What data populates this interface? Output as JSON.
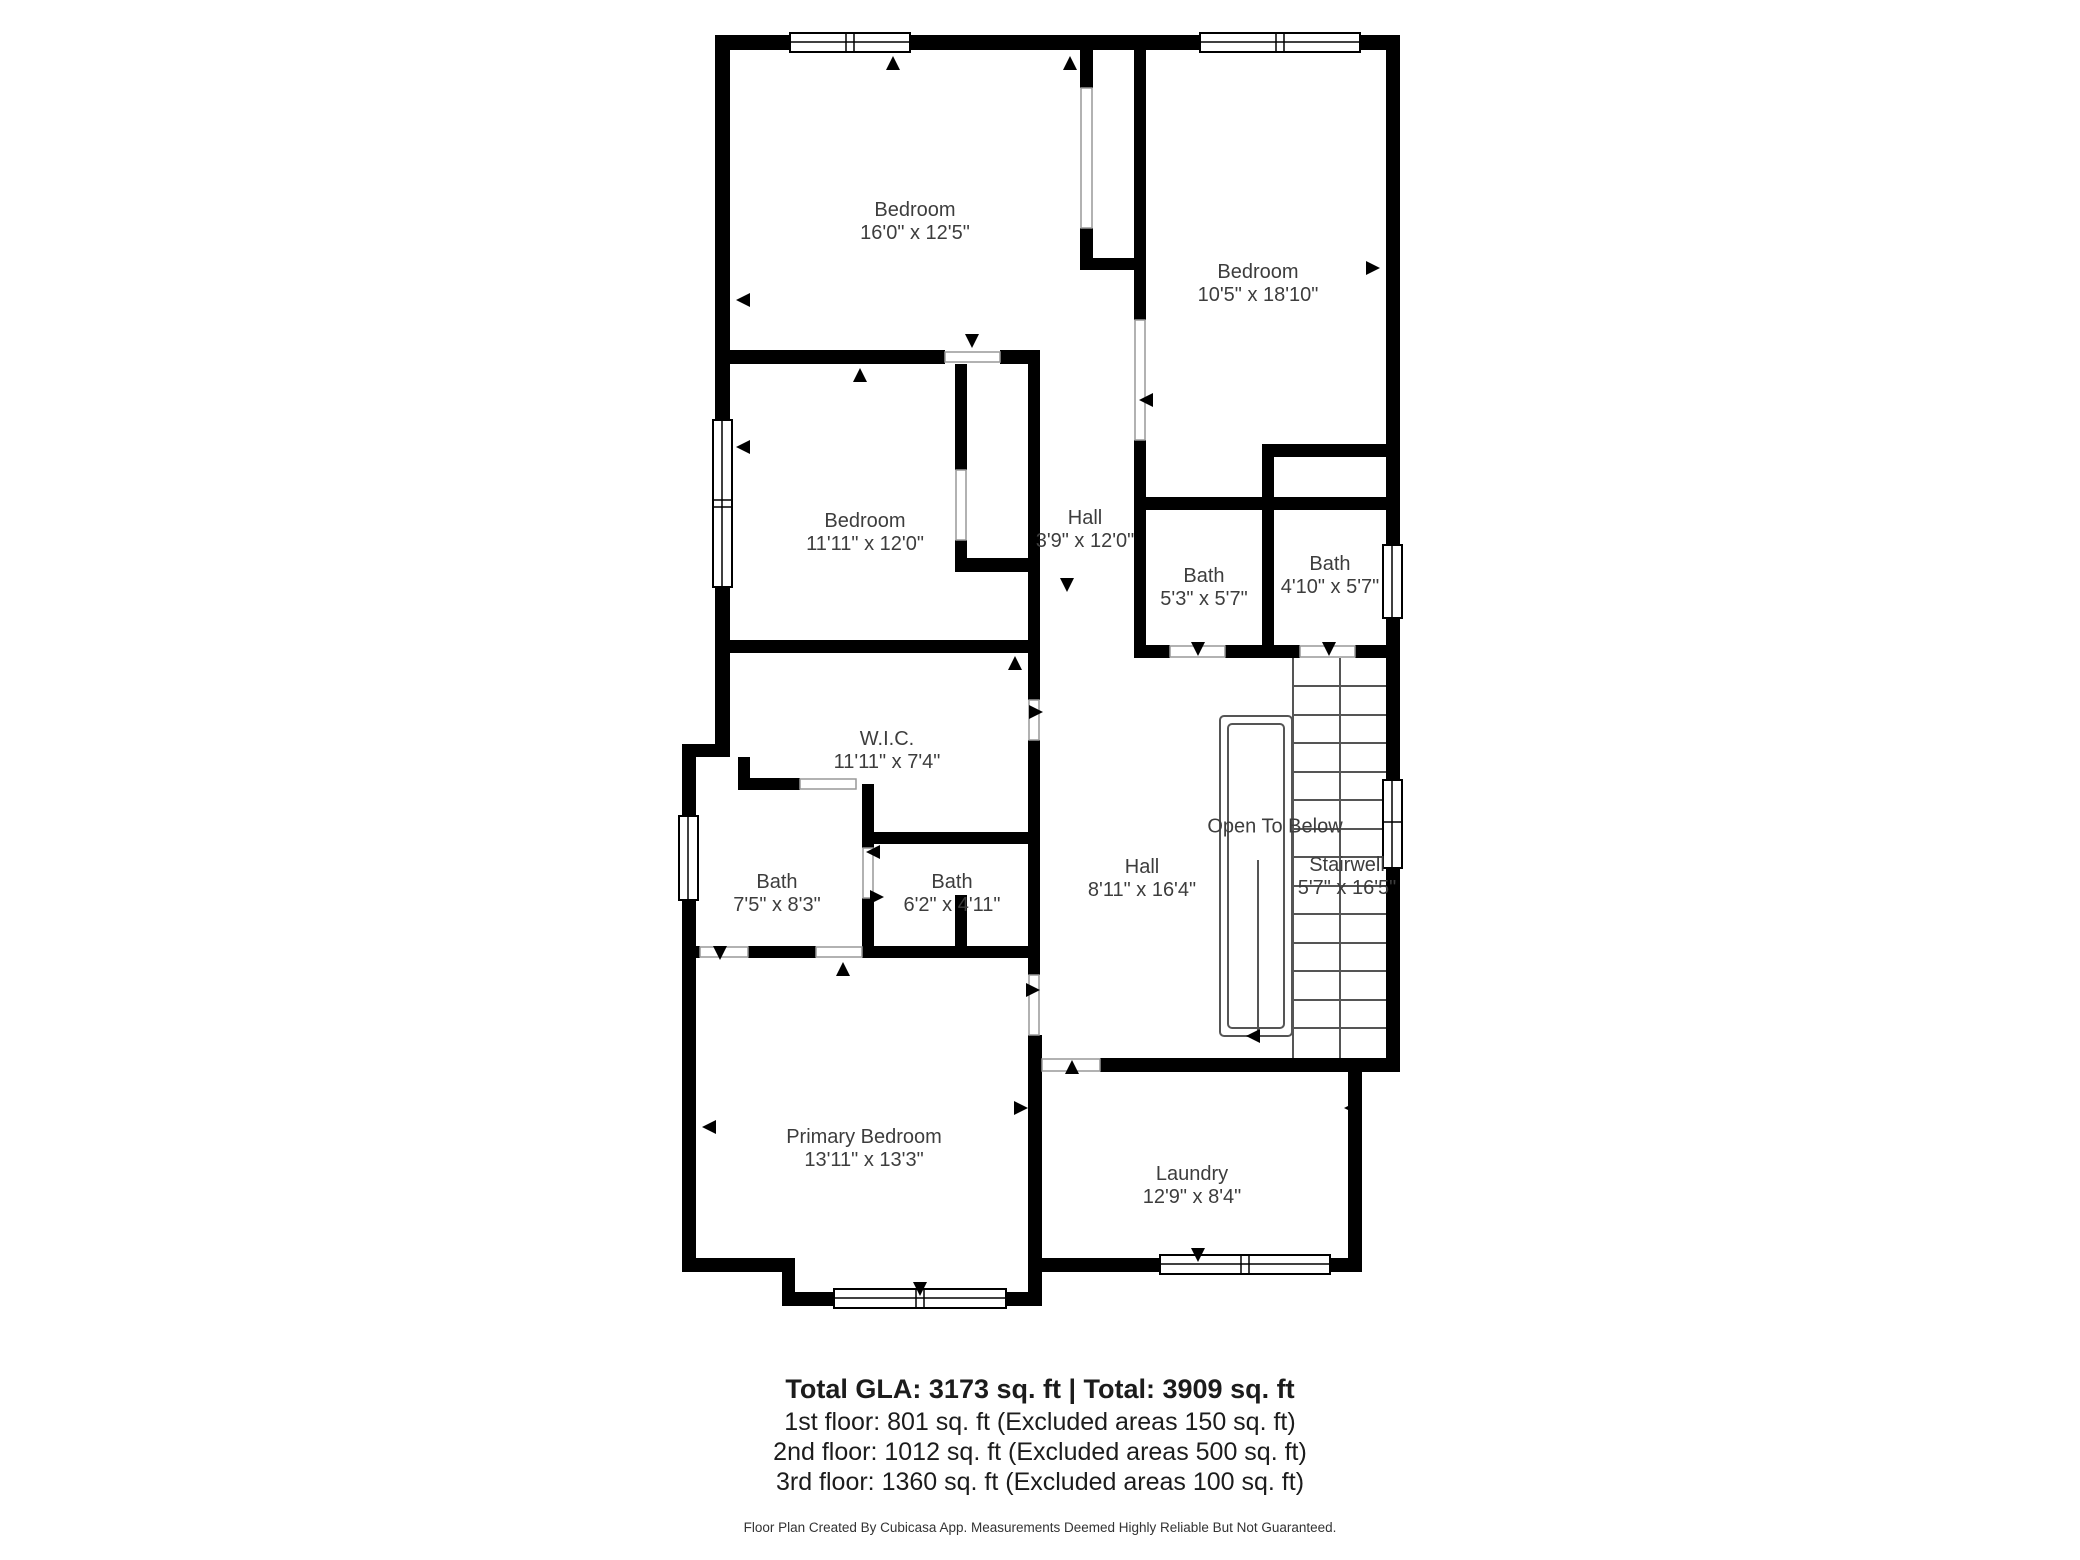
{
  "plan": {
    "rooms": [
      {
        "name": "Bedroom",
        "dims": "16'0\" x 12'5\""
      },
      {
        "name": "Bedroom",
        "dims": "10'5\" x 18'10\""
      },
      {
        "name": "Bedroom",
        "dims": "11'11\" x 12'0\""
      },
      {
        "name": "Hall",
        "dims": "3'9\" x 12'0\""
      },
      {
        "name": "Bath",
        "dims": "5'3\" x 5'7\""
      },
      {
        "name": "Bath",
        "dims": "4'10\" x 5'7\""
      },
      {
        "name": "W.I.C.",
        "dims": "11'11\" x 7'4\""
      },
      {
        "name": "Bath",
        "dims": "7'5\" x 8'3\""
      },
      {
        "name": "Bath",
        "dims": "6'2\" x 4'11\""
      },
      {
        "name": "Hall",
        "dims": "8'11\" x 16'4\""
      },
      {
        "name": "Open To Below",
        "dims": ""
      },
      {
        "name": "Stairwell",
        "dims": "5'7\" x 16'5\""
      },
      {
        "name": "Primary Bedroom",
        "dims": "13'11\" x 13'3\""
      },
      {
        "name": "Laundry",
        "dims": "12'9\" x 8'4\""
      }
    ],
    "footer": {
      "gla_line": "Total GLA: 3173 sq. ft | Total: 3909 sq. ft",
      "floor1": "1st floor: 801 sq. ft (Excluded areas 150 sq. ft)",
      "floor2": "2nd floor: 1012 sq. ft (Excluded areas 500 sq. ft)",
      "floor3": "3rd floor: 1360 sq. ft (Excluded areas 100 sq. ft)",
      "disclaimer": "Floor Plan Created By Cubicasa App. Measurements Deemed Highly Reliable But Not Guaranteed."
    },
    "colors": {
      "wall": "#000000",
      "label_text": "#3d3d3d",
      "footer_text": "#1c1c1c",
      "stair_line": "#555555"
    }
  }
}
